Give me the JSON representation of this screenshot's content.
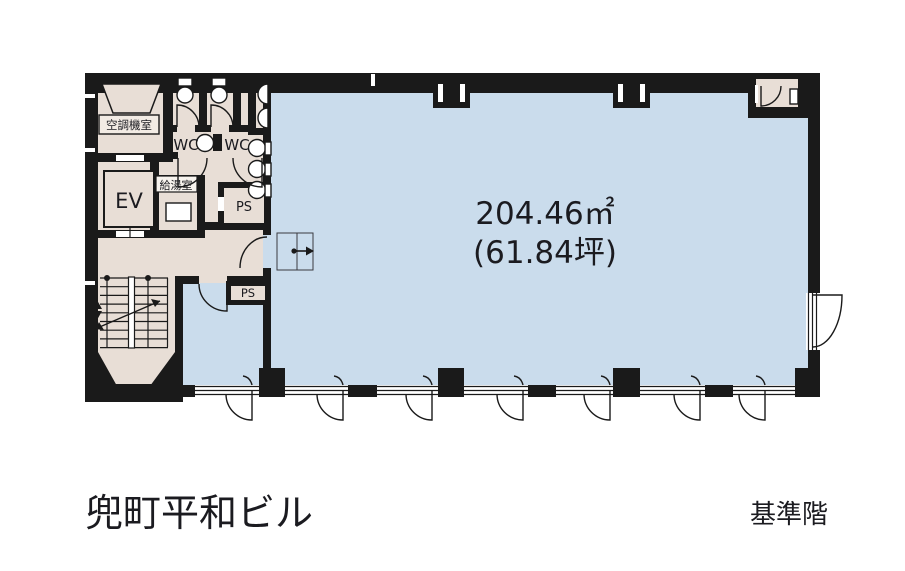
{
  "plan": {
    "building_name": "兜町平和ビル",
    "floor_type_label": "基準階",
    "main_room": {
      "area_m2": "204.46㎡",
      "area_tsubo": "(61.84坪)"
    },
    "rooms": {
      "ac_room": "空調機室",
      "elevator": "EV",
      "kitchenette": "給湯室",
      "wc_left": "WC",
      "wc_right": "WC",
      "ps_upper": "PS",
      "ps_lower": "PS"
    }
  },
  "colors": {
    "leasable_area": "#cadcec",
    "core_area": "#e8ded6",
    "walls": "#1a1a1a",
    "background": "#ffffff",
    "text": "#1b1b20"
  }
}
